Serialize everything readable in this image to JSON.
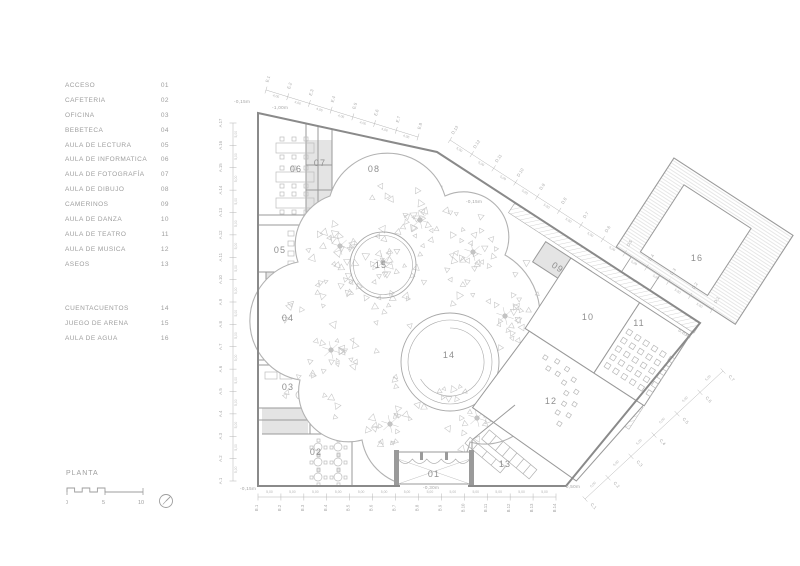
{
  "legend": {
    "groups": [
      {
        "items": [
          {
            "label": "ACCESO",
            "number": "01"
          },
          {
            "label": "CAFETERIA",
            "number": "02"
          },
          {
            "label": "OFICINA",
            "number": "03"
          },
          {
            "label": "BEBETECA",
            "number": "04"
          },
          {
            "label": "AULA DE LECTURA",
            "number": "05"
          },
          {
            "label": "AULA DE INFORMATICA",
            "number": "06"
          },
          {
            "label": "AULA DE FOTOGRAFÍA",
            "number": "07"
          },
          {
            "label": "AULA DE DIBUJO",
            "number": "08"
          },
          {
            "label": "CAMERINOS",
            "number": "09"
          },
          {
            "label": "AULA DE DANZA",
            "number": "10"
          },
          {
            "label": "AULA DE TEATRO",
            "number": "11"
          },
          {
            "label": "AULA DE MUSICA",
            "number": "12"
          },
          {
            "label": "ASEOS",
            "number": "13"
          }
        ]
      },
      {
        "items": [
          {
            "label": "CUENTACUENTOS",
            "number": "14"
          },
          {
            "label": "JUEGO DE ARENA",
            "number": "15"
          },
          {
            "label": "AULA DE AGUA",
            "number": "16"
          }
        ]
      }
    ]
  },
  "titleblock": {
    "title": "PLANTA",
    "scale_ticks": [
      "0",
      "5",
      "10"
    ]
  },
  "plan": {
    "room_labels": {
      "r01": "01",
      "r02": "02",
      "r03": "03",
      "r04": "04",
      "r05": "05",
      "r06": "06",
      "r07": "07",
      "r08": "08",
      "r09": "09",
      "r10": "10",
      "r11": "11",
      "r12": "12",
      "r13": "13",
      "r14": "14",
      "r15": "15",
      "r16": "16"
    },
    "levels": {
      "top_left": "-0,15m",
      "top": "-1,00m",
      "diagonal": "-0,15m",
      "bottom_left": "-0,15m",
      "bottom_center": "-0,30m",
      "bottom_right": "-0,50m",
      "right_edge": "0,63m",
      "ramp": "-1,20m"
    },
    "grid": {
      "A": {
        "labels": [
          "A.1",
          "A.2",
          "A.3",
          "A.4",
          "A.5",
          "A.6",
          "A.7",
          "A.8",
          "A.9",
          "A.10",
          "A.11",
          "A.12",
          "A.13",
          "A.14",
          "A.15",
          "A.16",
          "A.17"
        ],
        "dim": "5,00"
      },
      "B": {
        "labels": [
          "B.1",
          "B.2",
          "B.3",
          "B.4",
          "B.5",
          "B.6",
          "B.7",
          "B.8",
          "B.9",
          "B.10",
          "B.11",
          "B.12",
          "B.13",
          "B.14"
        ],
        "dim": "5,00"
      },
      "C": {
        "labels": [
          "C.1",
          "C.2",
          "C.3",
          "C.4",
          "C.5",
          "C.6",
          "C.7"
        ],
        "dim": "5,00"
      },
      "D": {
        "labels": [
          "D.1",
          "D.2",
          "D.3",
          "D.4",
          "D.5",
          "D.6",
          "D.7",
          "D.8",
          "D.9",
          "D.10",
          "D.11",
          "D.12",
          "D.13"
        ],
        "dim": "5,00"
      },
      "E": {
        "labels": [
          "E.1",
          "E.2",
          "E.3",
          "E.4",
          "E.5",
          "E.6",
          "E.7",
          "E.8"
        ],
        "dim": "4,06"
      }
    }
  }
}
